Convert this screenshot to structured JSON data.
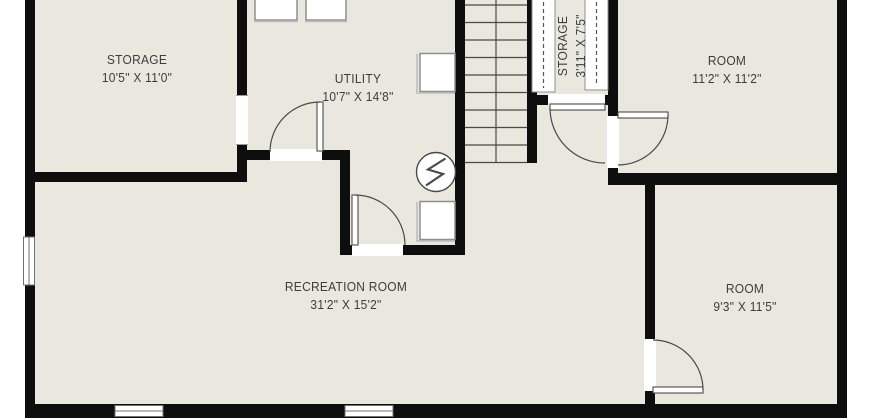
{
  "rooms": {
    "storage_left": {
      "name": "STORAGE",
      "dims": "10'5\" X 11'0\""
    },
    "utility": {
      "name": "UTILITY",
      "dims": "10'7\" X 14'8\""
    },
    "storage_closet": {
      "name": "STORAGE",
      "dims": "3'11\" X 7'5\""
    },
    "room_upper_right": {
      "name": "ROOM",
      "dims": "11'2\" X 11'2\""
    },
    "recreation": {
      "name": "RECREATION ROOM",
      "dims": "31'2\" X 15'2\""
    },
    "room_lower_right": {
      "name": "ROOM",
      "dims": "9'3\" X 11'5\""
    }
  },
  "icons": {
    "electrical_panel": "lightning-bolt",
    "closet_shelves": "dashed-rod-shelves",
    "doors": "quarter-arc-swing",
    "stairs": "straight-run-treads"
  },
  "colors": {
    "background": "#ffffff",
    "floor": "#e9e7de",
    "wall": "#0e0e0e",
    "line": "#4a4a4a",
    "fixture_border": "#8f8f8f",
    "text": "#3d3d3d"
  }
}
